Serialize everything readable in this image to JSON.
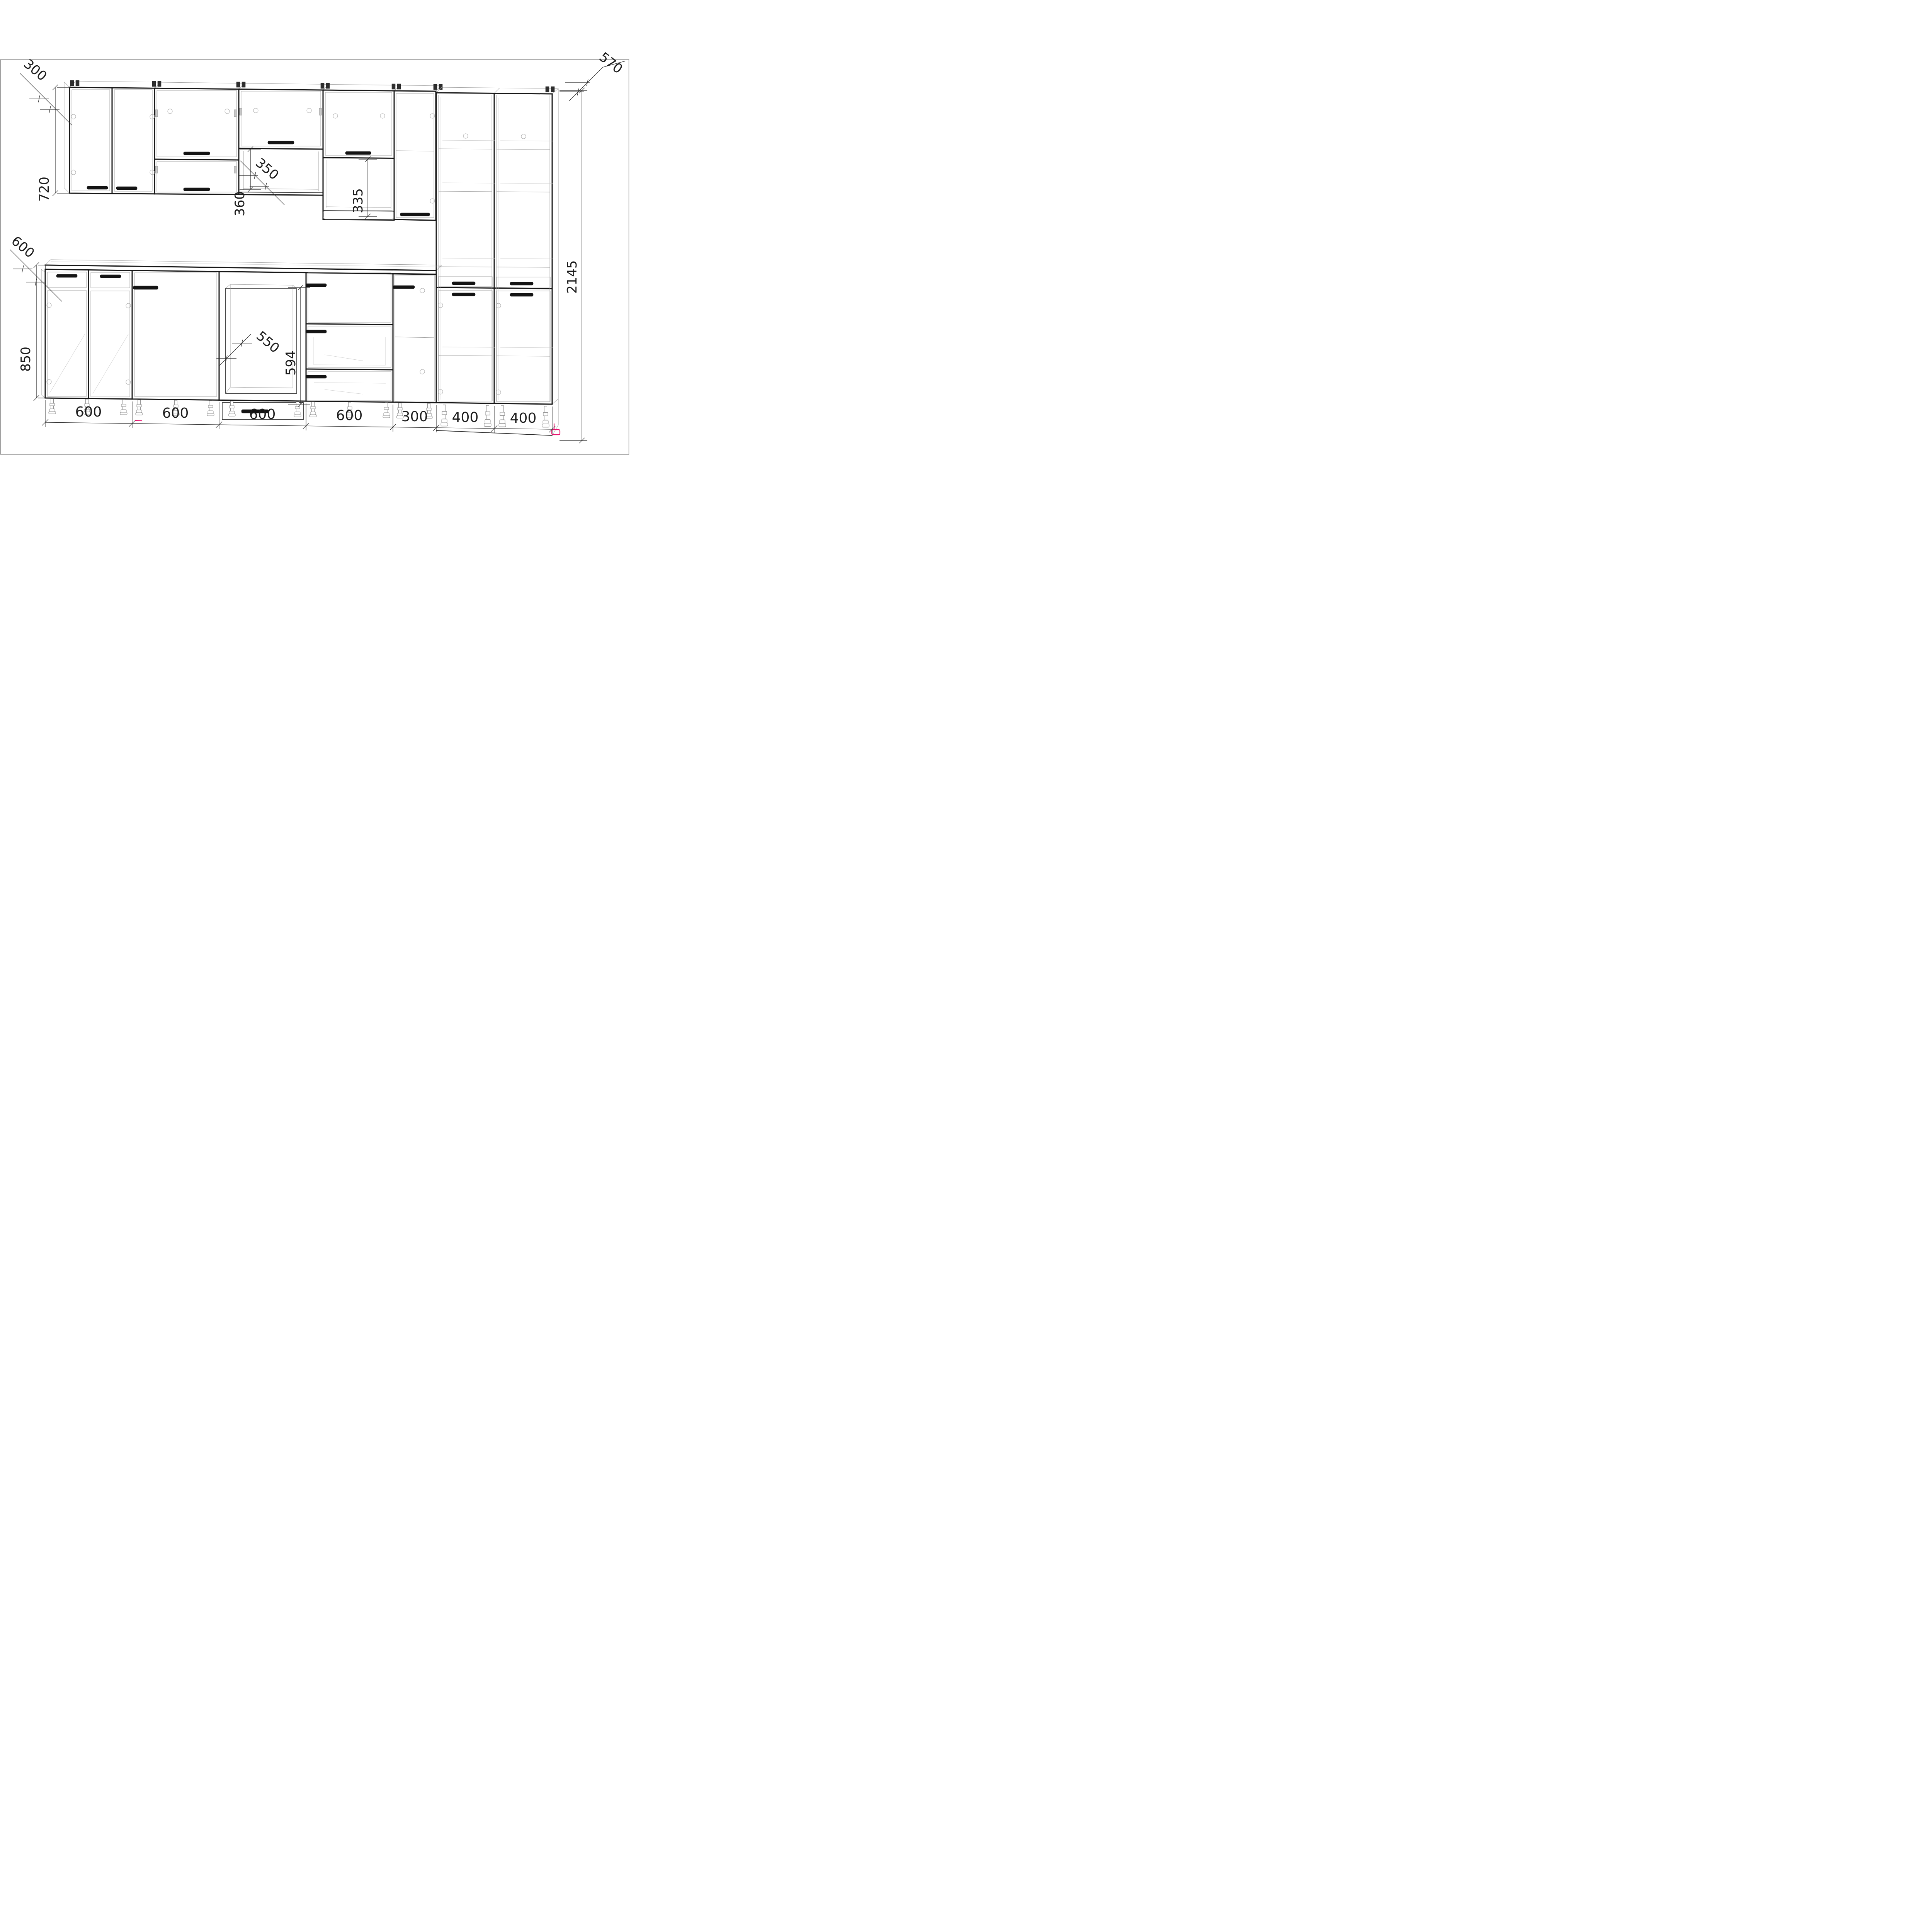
{
  "drawing": {
    "type": "kitchen-cabinet-set-wireframe-projection",
    "units": "mm",
    "dims": {
      "wall_depth": "300",
      "wall_height": "720",
      "flip_section_height": "360",
      "shelf_depth": "350",
      "niche_height": "335",
      "tall_depth": "570",
      "tall_height": "2145",
      "worktop_depth": "600",
      "base_height": "850",
      "oven_niche_width": "550",
      "oven_niche_height": "594",
      "chain": [
        "600",
        "600",
        "600",
        "600",
        "300",
        "400",
        "400"
      ]
    },
    "colors": {
      "line": "#161616",
      "light_line": "#9f9f9f",
      "dim_line": "#2b2b2b",
      "accent_pink": "#e8136e",
      "background": "#ffffff",
      "frame": "#8f8f8f"
    }
  }
}
